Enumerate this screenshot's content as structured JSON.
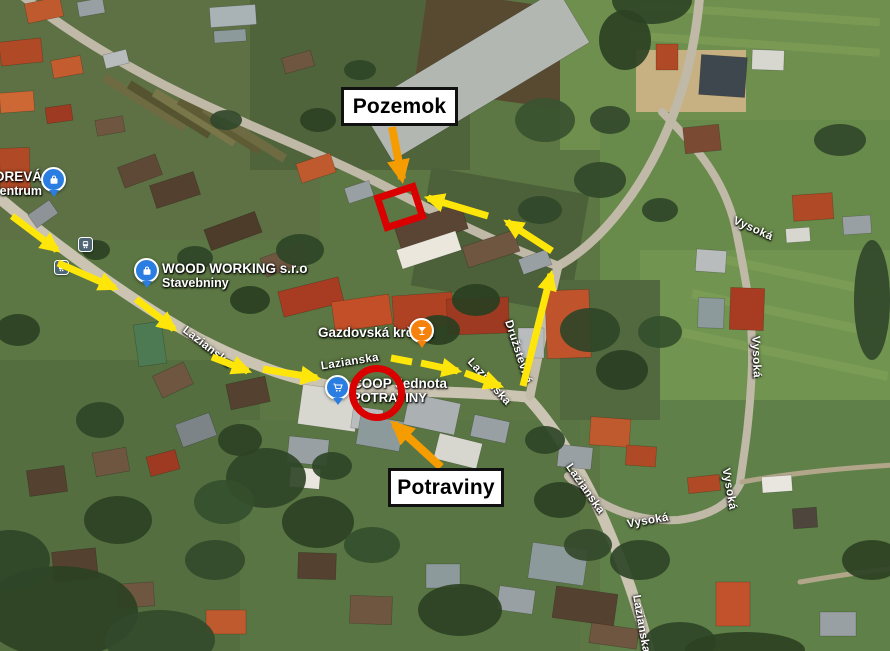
{
  "map": {
    "type": "satellite-imagery",
    "pois": {
      "dreva": {
        "line1": "DREVÁ",
        "line2": "e centrum",
        "icon": "shopping-bag-pin",
        "pin_color": "#2a7de1"
      },
      "woodworking": {
        "line1": "WOOD WORKING s.r.o",
        "line2": "Stavebniny",
        "icon": "shopping-bag-pin",
        "pin_color": "#2a7de1"
      },
      "krcma": {
        "line1": "Gazdovská krčma",
        "icon": "cocktail-pin",
        "pin_color": "#f5820d"
      },
      "coop": {
        "line1": "COOP Jednota",
        "line2": "POTRAVINY",
        "icon": "shopping-cart-pin",
        "pin_color": "#2a7de1"
      }
    },
    "streets": {
      "lazianska": "Lazianska",
      "vysoka": "Vysoká",
      "druzstevna": "Družstevná"
    },
    "transit": {
      "icon": "bus-stop-icon"
    }
  },
  "annotations": {
    "pozemok_label": "Pozemok",
    "potraviny_label": "Potraviny",
    "colors": {
      "route_yellow": "#ffe60a",
      "callout_arrow_orange": "#f59d00",
      "highlight_red": "#da0000"
    }
  }
}
